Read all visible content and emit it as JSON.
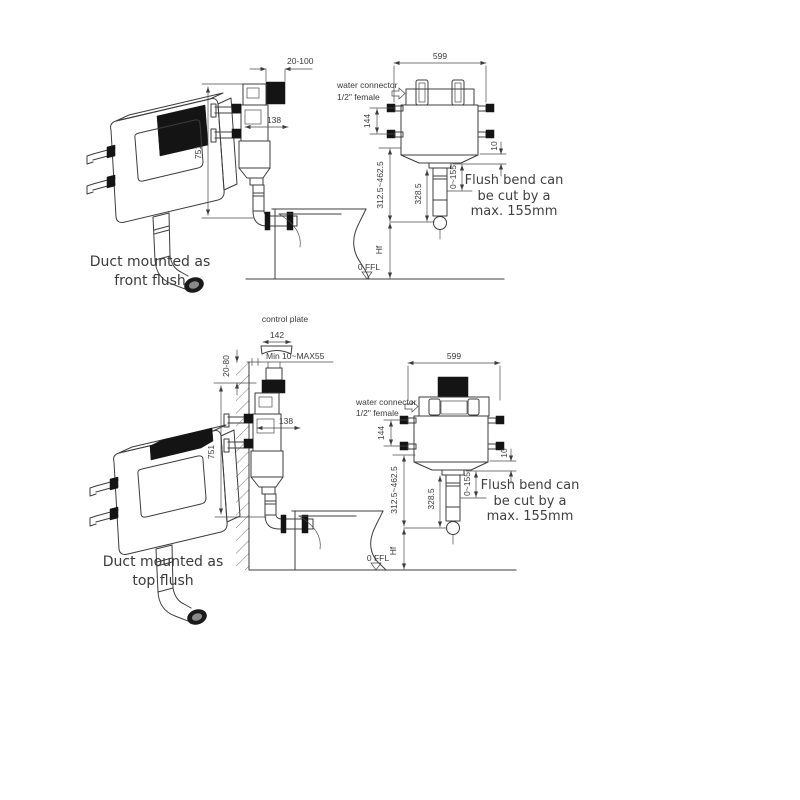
{
  "colors": {
    "line": "#3c3c3c",
    "black_fill": "#141414",
    "text": "#3a3a3a"
  },
  "front_flush": {
    "caption": [
      "Duct mounted as",
      "front flush"
    ],
    "side": {
      "dim_front_offset": "20-100",
      "dim_depth": "138",
      "dim_height": "751"
    },
    "front": {
      "dim_width": "599",
      "water_connector": [
        "water connector",
        "1/2\" female"
      ],
      "dim_inlet_height": "144",
      "dim_outlet_gap": "10",
      "dim_flush_pipe_range": "312.5~462.5",
      "dim_bend_length": "328.5",
      "dim_cut_range": "0~155",
      "dim_floor_height": "Hf"
    },
    "floor_level": "0 FFL",
    "note": [
      "Flush bend can",
      "be cut by a",
      "max. 155mm"
    ]
  },
  "top_flush": {
    "caption": [
      "Duct mounted as",
      "top flush"
    ],
    "control_plate": {
      "label": "control plate",
      "dim_width": "142",
      "dim_depth_range": "20-80",
      "dim_wall_range": "Min 10~MAX55"
    },
    "side": {
      "dim_depth": "138",
      "dim_height": "751"
    },
    "front": {
      "dim_width": "599",
      "water_connector": [
        "water connector",
        "1/2\" female"
      ],
      "dim_inlet_height": "144",
      "dim_outlet_gap": "10",
      "dim_flush_pipe_range": "312.5~462.5",
      "dim_bend_length": "328.5",
      "dim_cut_range": "0~155",
      "dim_floor_height": "Hf"
    },
    "floor_level": "0 FFL",
    "note": [
      "Flush bend can",
      "be cut by a",
      "max. 155mm"
    ]
  }
}
